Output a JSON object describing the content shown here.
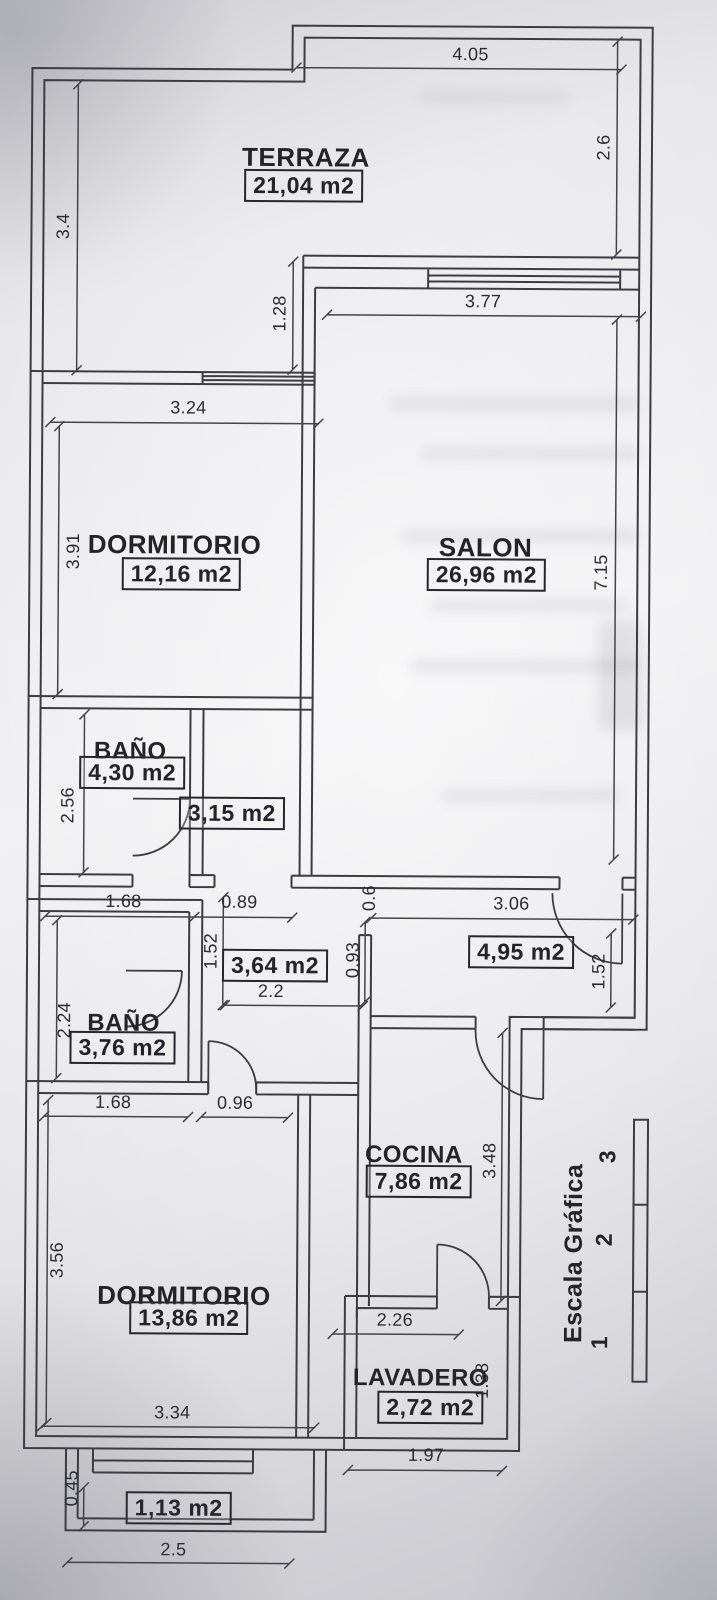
{
  "rooms": {
    "terraza": {
      "name": "TERRAZA",
      "area": "21,04 m2"
    },
    "dormitorio1": {
      "name": "DORMITORIO",
      "area": "12,16 m2"
    },
    "salon": {
      "name": "SALON",
      "area": "26,96 m2"
    },
    "bano1": {
      "name": "BAÑO",
      "area": "4,30 m2"
    },
    "hall1": {
      "area": "3,15 m2"
    },
    "hall2": {
      "area": "3,64 m2"
    },
    "hall3": {
      "area": "4,95 m2"
    },
    "bano2": {
      "name": "BAÑO",
      "area": "3,76 m2"
    },
    "cocina": {
      "name": "COCINA",
      "area": "7,86 m2"
    },
    "dormitorio2": {
      "name": "DORMITORIO",
      "area": "13,86 m2"
    },
    "lavadero": {
      "name": "LAVADERO",
      "area": "2,72 m2"
    },
    "balcon": {
      "area": "1,13 m2"
    }
  },
  "dims": {
    "terraza_top": "4.05",
    "terraza_right": "2.6",
    "terraza_left": "3.4",
    "terraza_salon_step": "1.28",
    "salon_top": "3.77",
    "dorm1_top": "3.24",
    "dorm1_left": "3.91",
    "salon_right": "7.15",
    "bano1_left": "2.56",
    "bano1_bottom": "1.68",
    "hall1_bottom": "0.89",
    "hall_pass": "0.6",
    "hall3_top": "3.06",
    "hall2_left": "1.52",
    "hall2_mid": "0.93",
    "hall2_bottom": "2.2",
    "hall3_door": "1.52",
    "bano2_left": "2.24",
    "bano2_bottom": "1.68",
    "hall2_low": "0.96",
    "cocina_right": "3.48",
    "dorm2_left": "3.56",
    "cocina_bottom": "2.26",
    "dorm2_bottom": "3.34",
    "lavadero_right": "1.38",
    "lavadero_bottom": "1.97",
    "balcon_left": "0.45",
    "balcon_bottom": "2.5"
  },
  "scale_bar": {
    "label": "Escala Gráfica",
    "ticks": [
      "1",
      "2",
      "3"
    ]
  }
}
